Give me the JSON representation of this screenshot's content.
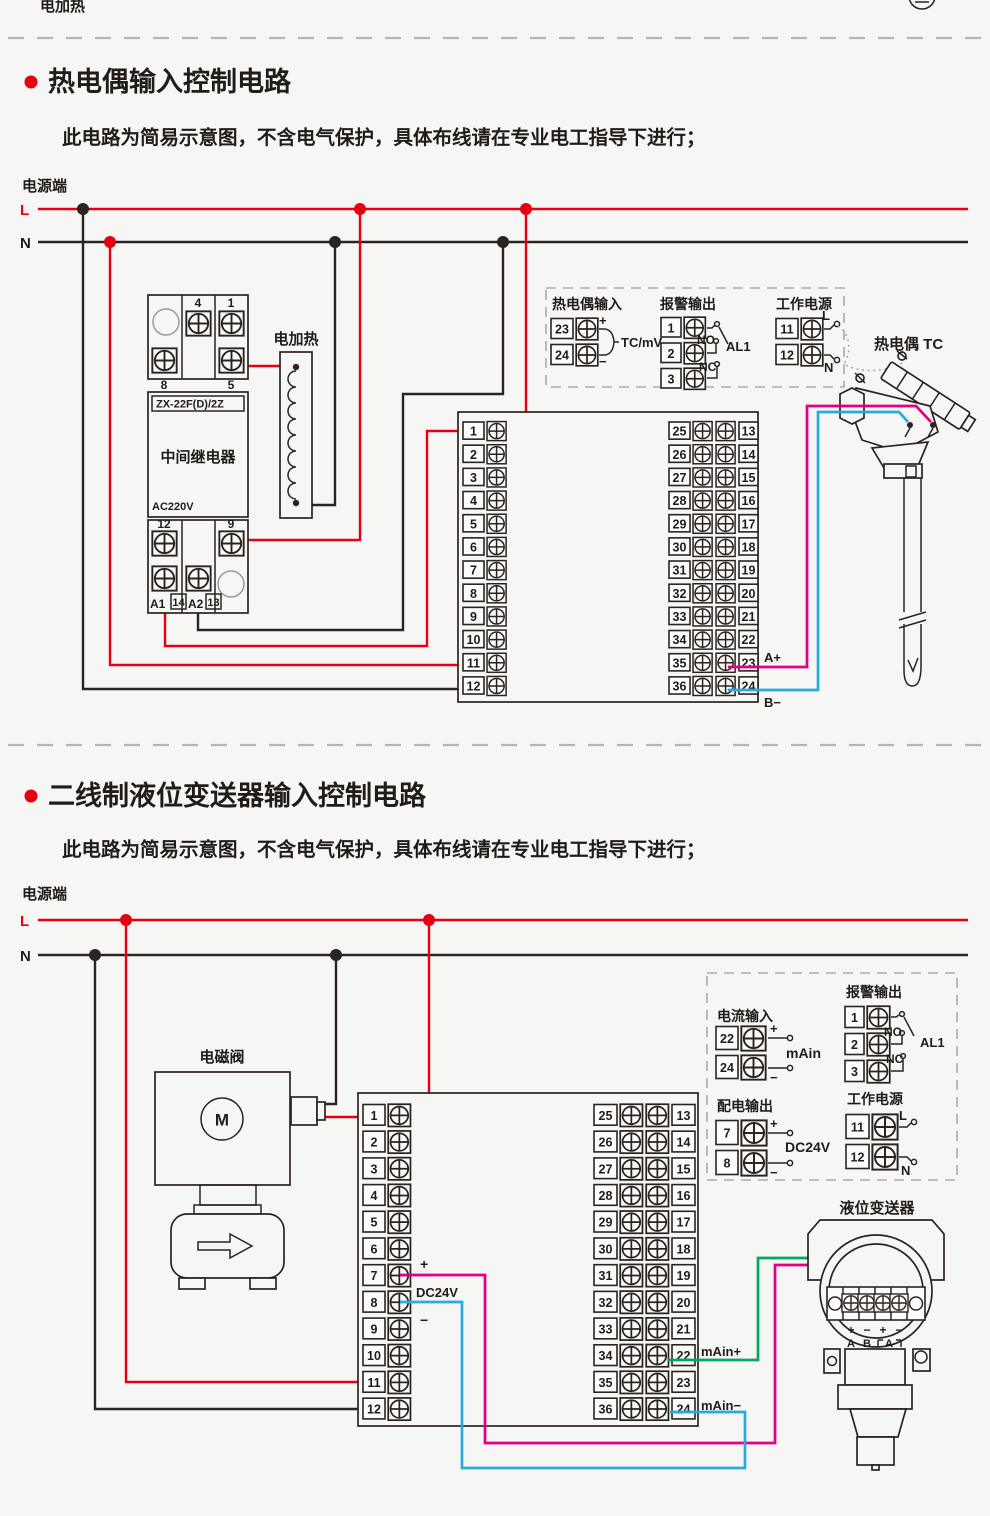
{
  "top": {
    "partial_label": "电加热"
  },
  "diagram1": {
    "title": "热电偶输入控制电路",
    "subtitle": "此电路为简易示意图，不含电气保护，具体布线请在专业电工指导下进行；",
    "power_label": "电源端",
    "l": "L",
    "n": "N",
    "relay": {
      "terminals_top": [
        "4",
        "1"
      ],
      "terminals_mid": [
        "8",
        "5"
      ],
      "model": "ZX-22F(D)/2Z",
      "name": "中间继电器",
      "voltage": "AC220V",
      "terminals_bottom": [
        "12",
        "9"
      ],
      "terminals_base": [
        "A1",
        "14",
        "A2",
        "13"
      ]
    },
    "heater": {
      "label": "电加热"
    },
    "io_box": {
      "tc_input": {
        "title": "热电偶输入",
        "terminals": [
          "23",
          "24"
        ],
        "plus": "+",
        "minus": "−",
        "signal": "TC/mV"
      },
      "alarm": {
        "title": "报警输出",
        "terminals": [
          "1",
          "2",
          "3"
        ],
        "no": "NO",
        "nc": "NC",
        "name": "AL1"
      },
      "power": {
        "title": "工作电源",
        "terminals": [
          "11",
          "12"
        ],
        "l": "L",
        "n": "N"
      }
    },
    "block": {
      "left": [
        "1",
        "2",
        "3",
        "4",
        "5",
        "6",
        "7",
        "8",
        "9",
        "10",
        "11",
        "12"
      ],
      "mid": [
        "25",
        "26",
        "27",
        "28",
        "29",
        "30",
        "31",
        "32",
        "33",
        "34",
        "35",
        "36"
      ],
      "right": [
        "13",
        "14",
        "15",
        "16",
        "17",
        "18",
        "19",
        "20",
        "21",
        "22",
        "23",
        "24"
      ],
      "a_plus": "A+",
      "b_minus": "B−"
    },
    "tc": {
      "label": "热电偶 TC"
    }
  },
  "diagram2": {
    "title": "二线制液位变送器输入控制电路",
    "subtitle": "此电路为简易示意图，不含电气保护，具体布线请在专业电工指导下进行；",
    "power_label": "电源端",
    "l": "L",
    "n": "N",
    "valve": {
      "label": "电磁阀",
      "motor": "M"
    },
    "io_box": {
      "current_input": {
        "title": "电流输入",
        "terminals": [
          "22",
          "24"
        ],
        "plus": "+",
        "minus": "−",
        "signal": "mAin"
      },
      "alarm": {
        "title": "报警输出",
        "terminals": [
          "1",
          "2",
          "3"
        ],
        "no": "NO",
        "nc": "NC",
        "name": "AL1"
      },
      "dist_output": {
        "title": "配电输出",
        "terminals": [
          "7",
          "8"
        ],
        "plus": "+",
        "minus": "−",
        "signal": "DC24V"
      },
      "power": {
        "title": "工作电源",
        "terminals": [
          "11",
          "12"
        ],
        "l": "L",
        "n": "N"
      }
    },
    "block": {
      "left": [
        "1",
        "2",
        "3",
        "4",
        "5",
        "6",
        "7",
        "8",
        "9",
        "10",
        "11",
        "12"
      ],
      "mid": [
        "25",
        "26",
        "27",
        "28",
        "29",
        "30",
        "31",
        "32",
        "33",
        "34",
        "35",
        "36"
      ],
      "right": [
        "13",
        "14",
        "15",
        "16",
        "17",
        "18",
        "19",
        "20",
        "21",
        "22",
        "23",
        "24"
      ],
      "dc_plus": "+",
      "dc_label": "DC24V",
      "dc_minus": "−",
      "main_plus": "mAin+",
      "main_minus": "mAin−"
    },
    "transmitter": {
      "label": "液位变送器",
      "marks": [
        "+",
        "−",
        "+",
        "−"
      ],
      "letters": [
        "A",
        "B",
        "A"
      ]
    }
  }
}
